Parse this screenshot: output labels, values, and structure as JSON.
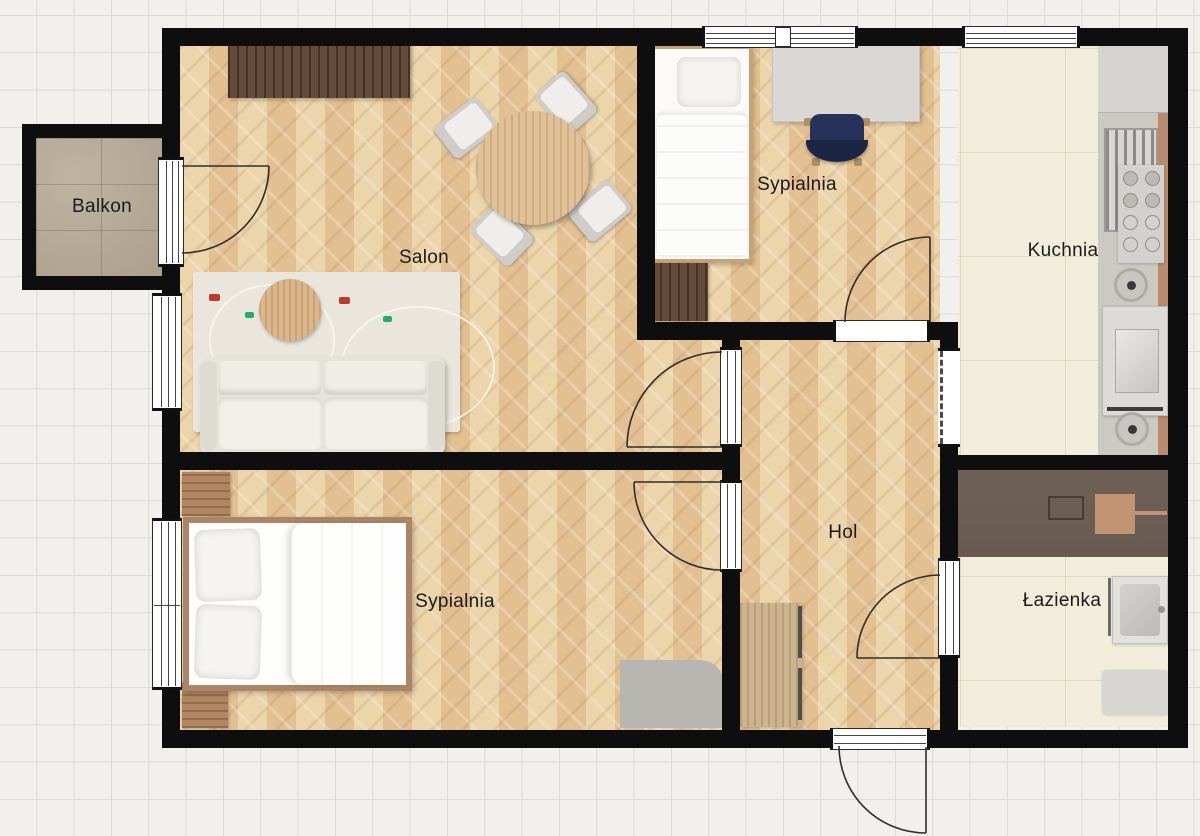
{
  "plan": {
    "kind": "apartment-floor-plan",
    "rooms": [
      {
        "id": "balkon",
        "label": "Balkon"
      },
      {
        "id": "salon",
        "label": "Salon"
      },
      {
        "id": "sypialnia-gorna",
        "label": "Sypialnia"
      },
      {
        "id": "kuchnia",
        "label": "Kuchnia"
      },
      {
        "id": "hol",
        "label": "Hol"
      },
      {
        "id": "sypialnia-dolna",
        "label": "Sypialnia"
      },
      {
        "id": "lazienka",
        "label": "Łazienka"
      }
    ],
    "furniture": [
      "sideboard",
      "dining-table",
      "dining-chair",
      "play-rug",
      "coffee-table",
      "sofa",
      "single-bed",
      "dresser",
      "desk",
      "office-chair",
      "fridge",
      "dishwasher",
      "stove-panel",
      "burner",
      "oven",
      "kitchen-counter",
      "bathroom-counter",
      "laptop",
      "stool",
      "washbasin",
      "washing-machine",
      "double-bed",
      "nightstand",
      "wardrobe",
      "floor-mat"
    ],
    "palette": {
      "wall": "#0e0e0e",
      "wood_floor": "#e8c99d",
      "tile_floor": "#f2edda",
      "balcony_floor": "#b6a995",
      "counter_dark_brown": "#6f6156",
      "furniture_wood_dark": "#5c4130",
      "furniture_wood_mid": "#c09a6e",
      "fabric_white": "#f2f1ec",
      "desk_gray": "#d9d8d5",
      "chair_navy": "#263259",
      "grid_line": "#dcdbd4",
      "background": "#f1f0ec"
    }
  }
}
